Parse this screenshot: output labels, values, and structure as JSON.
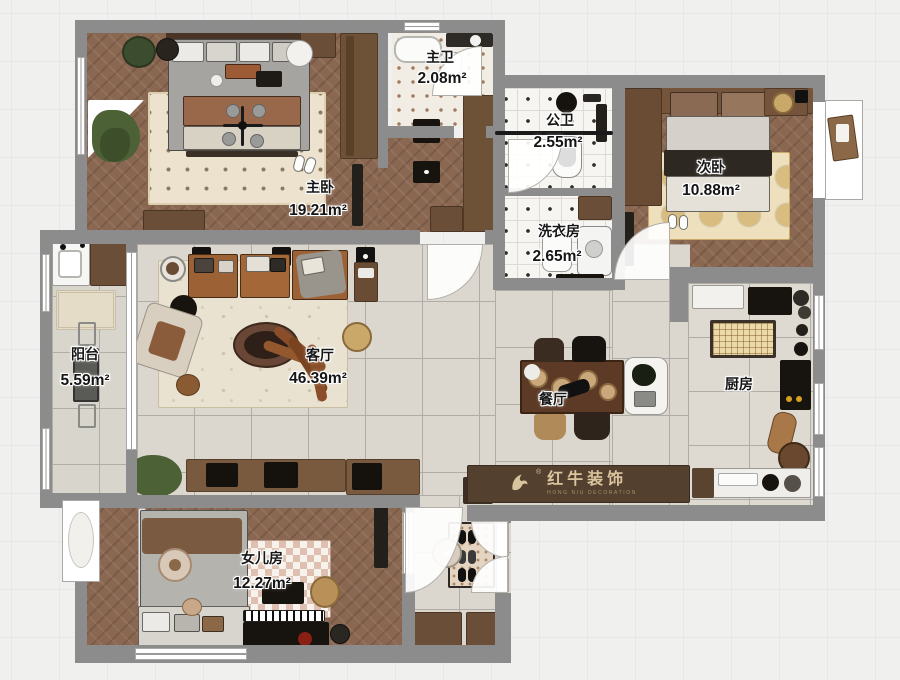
{
  "plan": {
    "rooms": [
      {
        "id": "master-bedroom",
        "name": "主卧",
        "area": "19.21m²"
      },
      {
        "id": "master-bath",
        "name": "主卫",
        "area": "2.08m²"
      },
      {
        "id": "guest-bath",
        "name": "公卫",
        "area": "2.55m²"
      },
      {
        "id": "laundry",
        "name": "洗衣房",
        "area": "2.65m²"
      },
      {
        "id": "second-bedroom",
        "name": "次卧",
        "area": "10.88m²"
      },
      {
        "id": "balcony",
        "name": "阳台",
        "area": "5.59m²"
      },
      {
        "id": "living-room",
        "name": "客厅",
        "area": "46.39m²"
      },
      {
        "id": "dining-room",
        "name": "餐厅",
        "area": ""
      },
      {
        "id": "kitchen",
        "name": "厨房",
        "area": ""
      },
      {
        "id": "daughters-room",
        "name": "女儿房",
        "area": "12.27m²"
      }
    ],
    "watermark": {
      "brand": "红牛装饰",
      "sub": "HONG NIU DECORATION",
      "reg": "®"
    },
    "colors": {
      "wall": "#8c8c8c",
      "wood_floor": "#8a6750",
      "tile_floor": "#dbd7cf",
      "accent_wood": "#6e5238",
      "logo_bg": "#54402f",
      "logo_text": "#d9c49e"
    }
  }
}
